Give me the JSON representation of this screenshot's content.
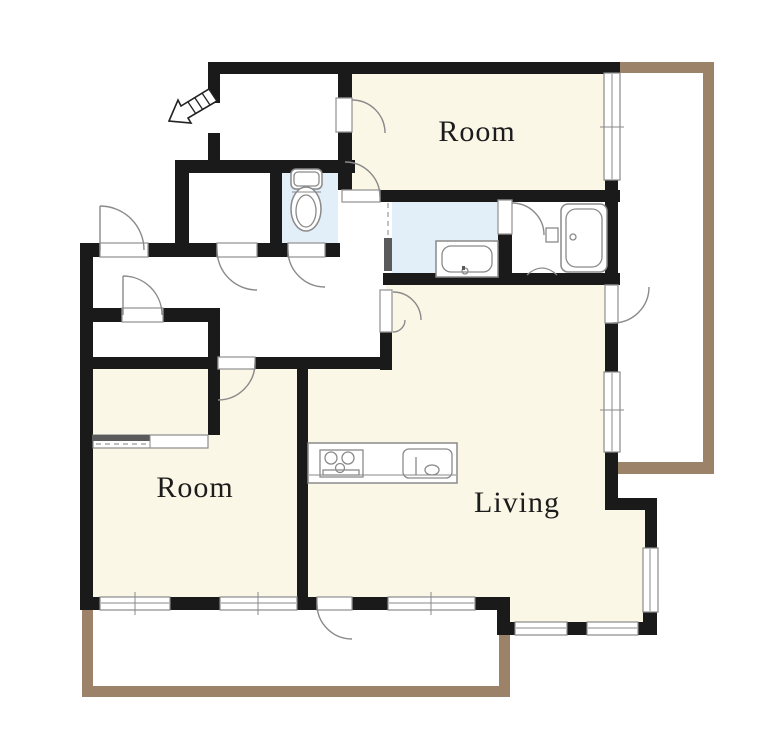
{
  "figure_type": "apartment-floor-plan",
  "labels": {
    "room_top": "Room",
    "room_bottom": "Room",
    "living": "Living"
  },
  "colors": {
    "wall": "#1a1a1a",
    "room": "#fbf7e7",
    "wet": "#e2eef8",
    "rail": "#9b8268",
    "text": "#1c1c1c",
    "background": "#ffffff"
  },
  "icons": {
    "entrance_arrow": "entrance-arrow-icon",
    "toilet": "toilet-icon",
    "bathtub": "bathtub-icon",
    "washbasin": "washbasin-icon",
    "stove": "stove-icon",
    "kitchen_sink": "kitchen-sink-icon",
    "sliding_closet_door": "sliding-door-icon",
    "folding_door": "folding-door-icon",
    "swing_door": "door-swing-icon",
    "window": "window-icon"
  }
}
